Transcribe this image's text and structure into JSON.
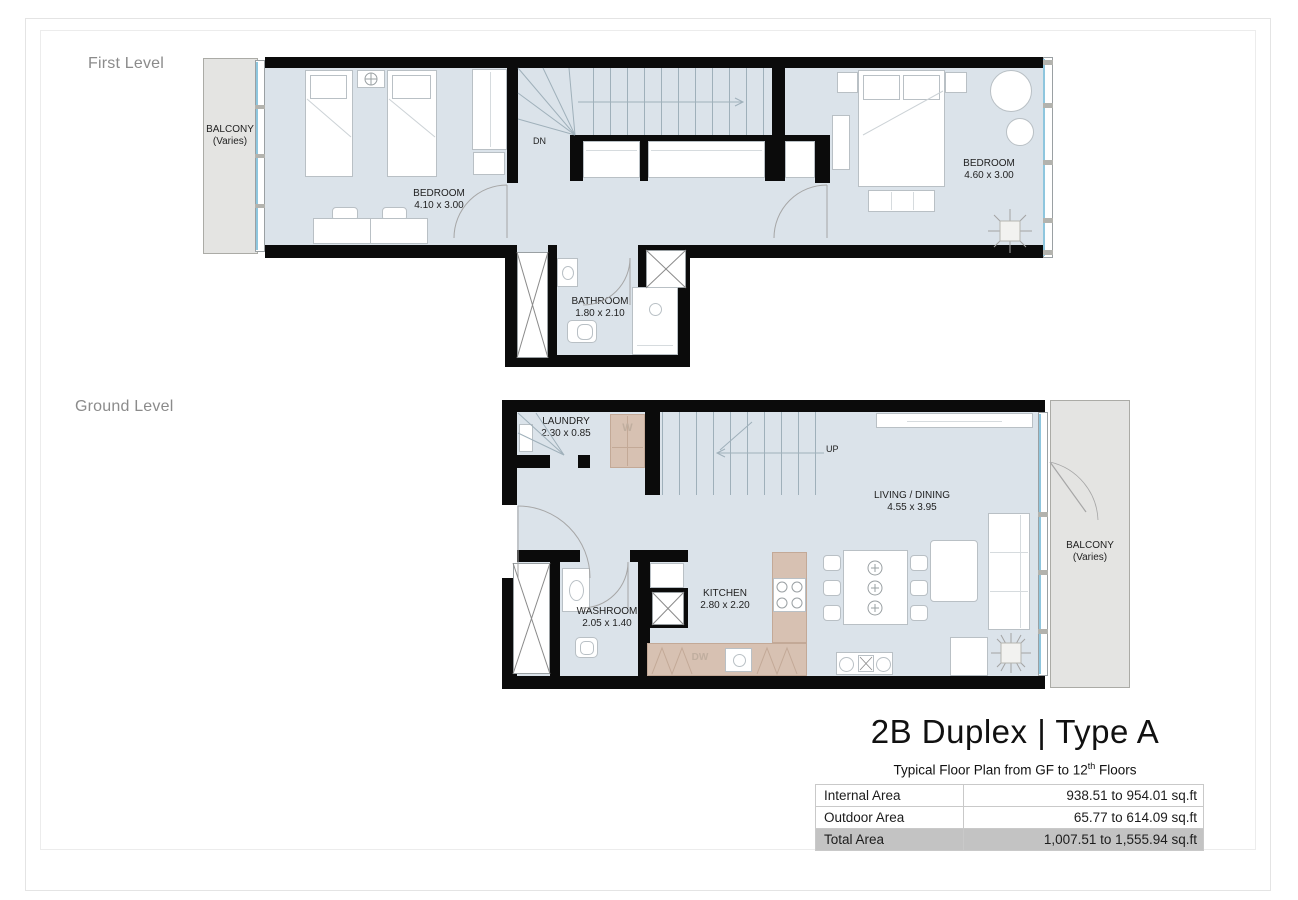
{
  "levels": {
    "first": "First Level",
    "ground": "Ground Level"
  },
  "first_level": {
    "balcony_line1": "BALCONY",
    "balcony_line2": "(Varies)",
    "bedroom_left_name": "BEDROOM",
    "bedroom_left_dims": "4.10 x 3.00",
    "bedroom_right_name": "BEDROOM",
    "bedroom_right_dims": "4.60 x 3.00",
    "bathroom_name": "BATHROOM",
    "bathroom_dims": "1.80 x 2.10",
    "stair_label": "DN"
  },
  "ground_level": {
    "balcony_line1": "BALCONY",
    "balcony_line2": "(Varies)",
    "laundry_name": "LAUNDRY",
    "laundry_dims": "2.30 x 0.85",
    "living_name": "LIVING / DINING",
    "living_dims": "4.55 x 3.95",
    "washroom_name": "WASHROOM",
    "washroom_dims": "2.05 x 1.40",
    "kitchen_name": "KITCHEN",
    "kitchen_dims": "2.80 x 2.20",
    "stair_label": "UP",
    "washer_label": "W",
    "dishwasher_label": "DW"
  },
  "title_block": {
    "title": "2B Duplex | Type A",
    "subtitle_prefix": "Typical Floor Plan from GF to 12",
    "subtitle_sup": "th",
    "subtitle_suffix": " Floors",
    "table": {
      "rows": [
        {
          "label": "Internal Area",
          "value": "938.51 to 954.01 sq.ft"
        },
        {
          "label": "Outdoor Area",
          "value": "65.77 to 614.09 sq.ft"
        },
        {
          "label": "Total Area",
          "value": "1,007.51 to 1,555.94 sq.ft"
        }
      ]
    }
  },
  "colors": {
    "floor": "#dbe3ea",
    "wall": "#0b0b0b",
    "counter_tan": "#d7c1b2",
    "balcony_gray": "#e4e4e2",
    "window_glass": "#8ec6de",
    "total_row_highlight": "#c3c3c3"
  }
}
